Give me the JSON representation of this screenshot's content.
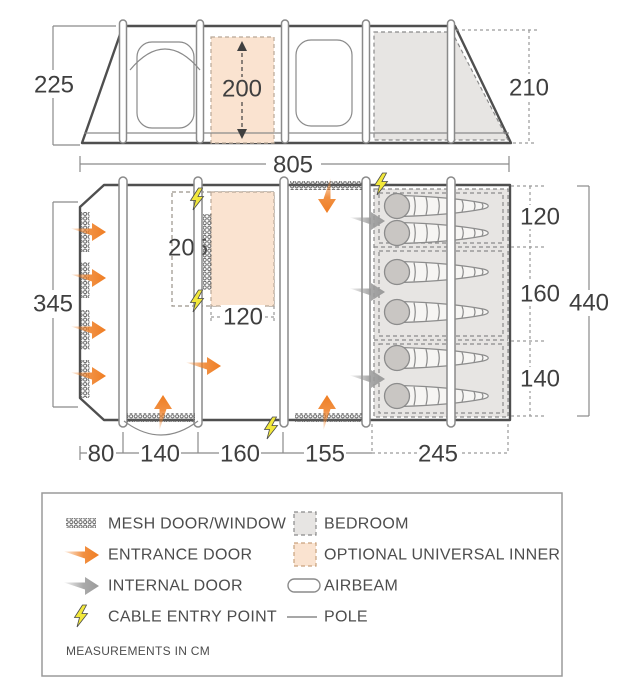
{
  "dims": {
    "elevation_left_height": "225",
    "elevation_inner_height": "200",
    "elevation_right_height": "210",
    "total_length": "805",
    "plan_left_side": "345",
    "inner_length": "205",
    "inner_width": "120",
    "plan_width_total": "440",
    "right_sections": [
      "120",
      "160",
      "140"
    ],
    "bottom_sections": [
      "80",
      "140",
      "160",
      "155",
      "245"
    ]
  },
  "legend": {
    "left": [
      {
        "icon": "mesh-door-window-icon",
        "label": "MESH DOOR/WINDOW"
      },
      {
        "icon": "entrance-door-icon",
        "label": "ENTRANCE DOOR"
      },
      {
        "icon": "internal-door-icon",
        "label": "INTERNAL DOOR"
      },
      {
        "icon": "cable-entry-point-icon",
        "label": "CABLE ENTRY POINT"
      }
    ],
    "right": [
      {
        "icon": "bedroom-icon",
        "label": "BEDROOM"
      },
      {
        "icon": "optional-universal-inner-icon",
        "label": "OPTIONAL UNIVERSAL INNER"
      },
      {
        "icon": "airbeam-icon",
        "label": "AIRBEAM"
      },
      {
        "icon": "pole-icon",
        "label": "POLE"
      }
    ],
    "note": "MEASUREMENTS IN CM"
  },
  "colors": {
    "entrance_door": "#ef7d22",
    "internal_door": "#9b9b9b",
    "cable_point": "#f2e83b",
    "bedroom_fill": "#e7e5e3",
    "inner_fill": "#fae3d0",
    "outline": "#4f4f4f"
  }
}
